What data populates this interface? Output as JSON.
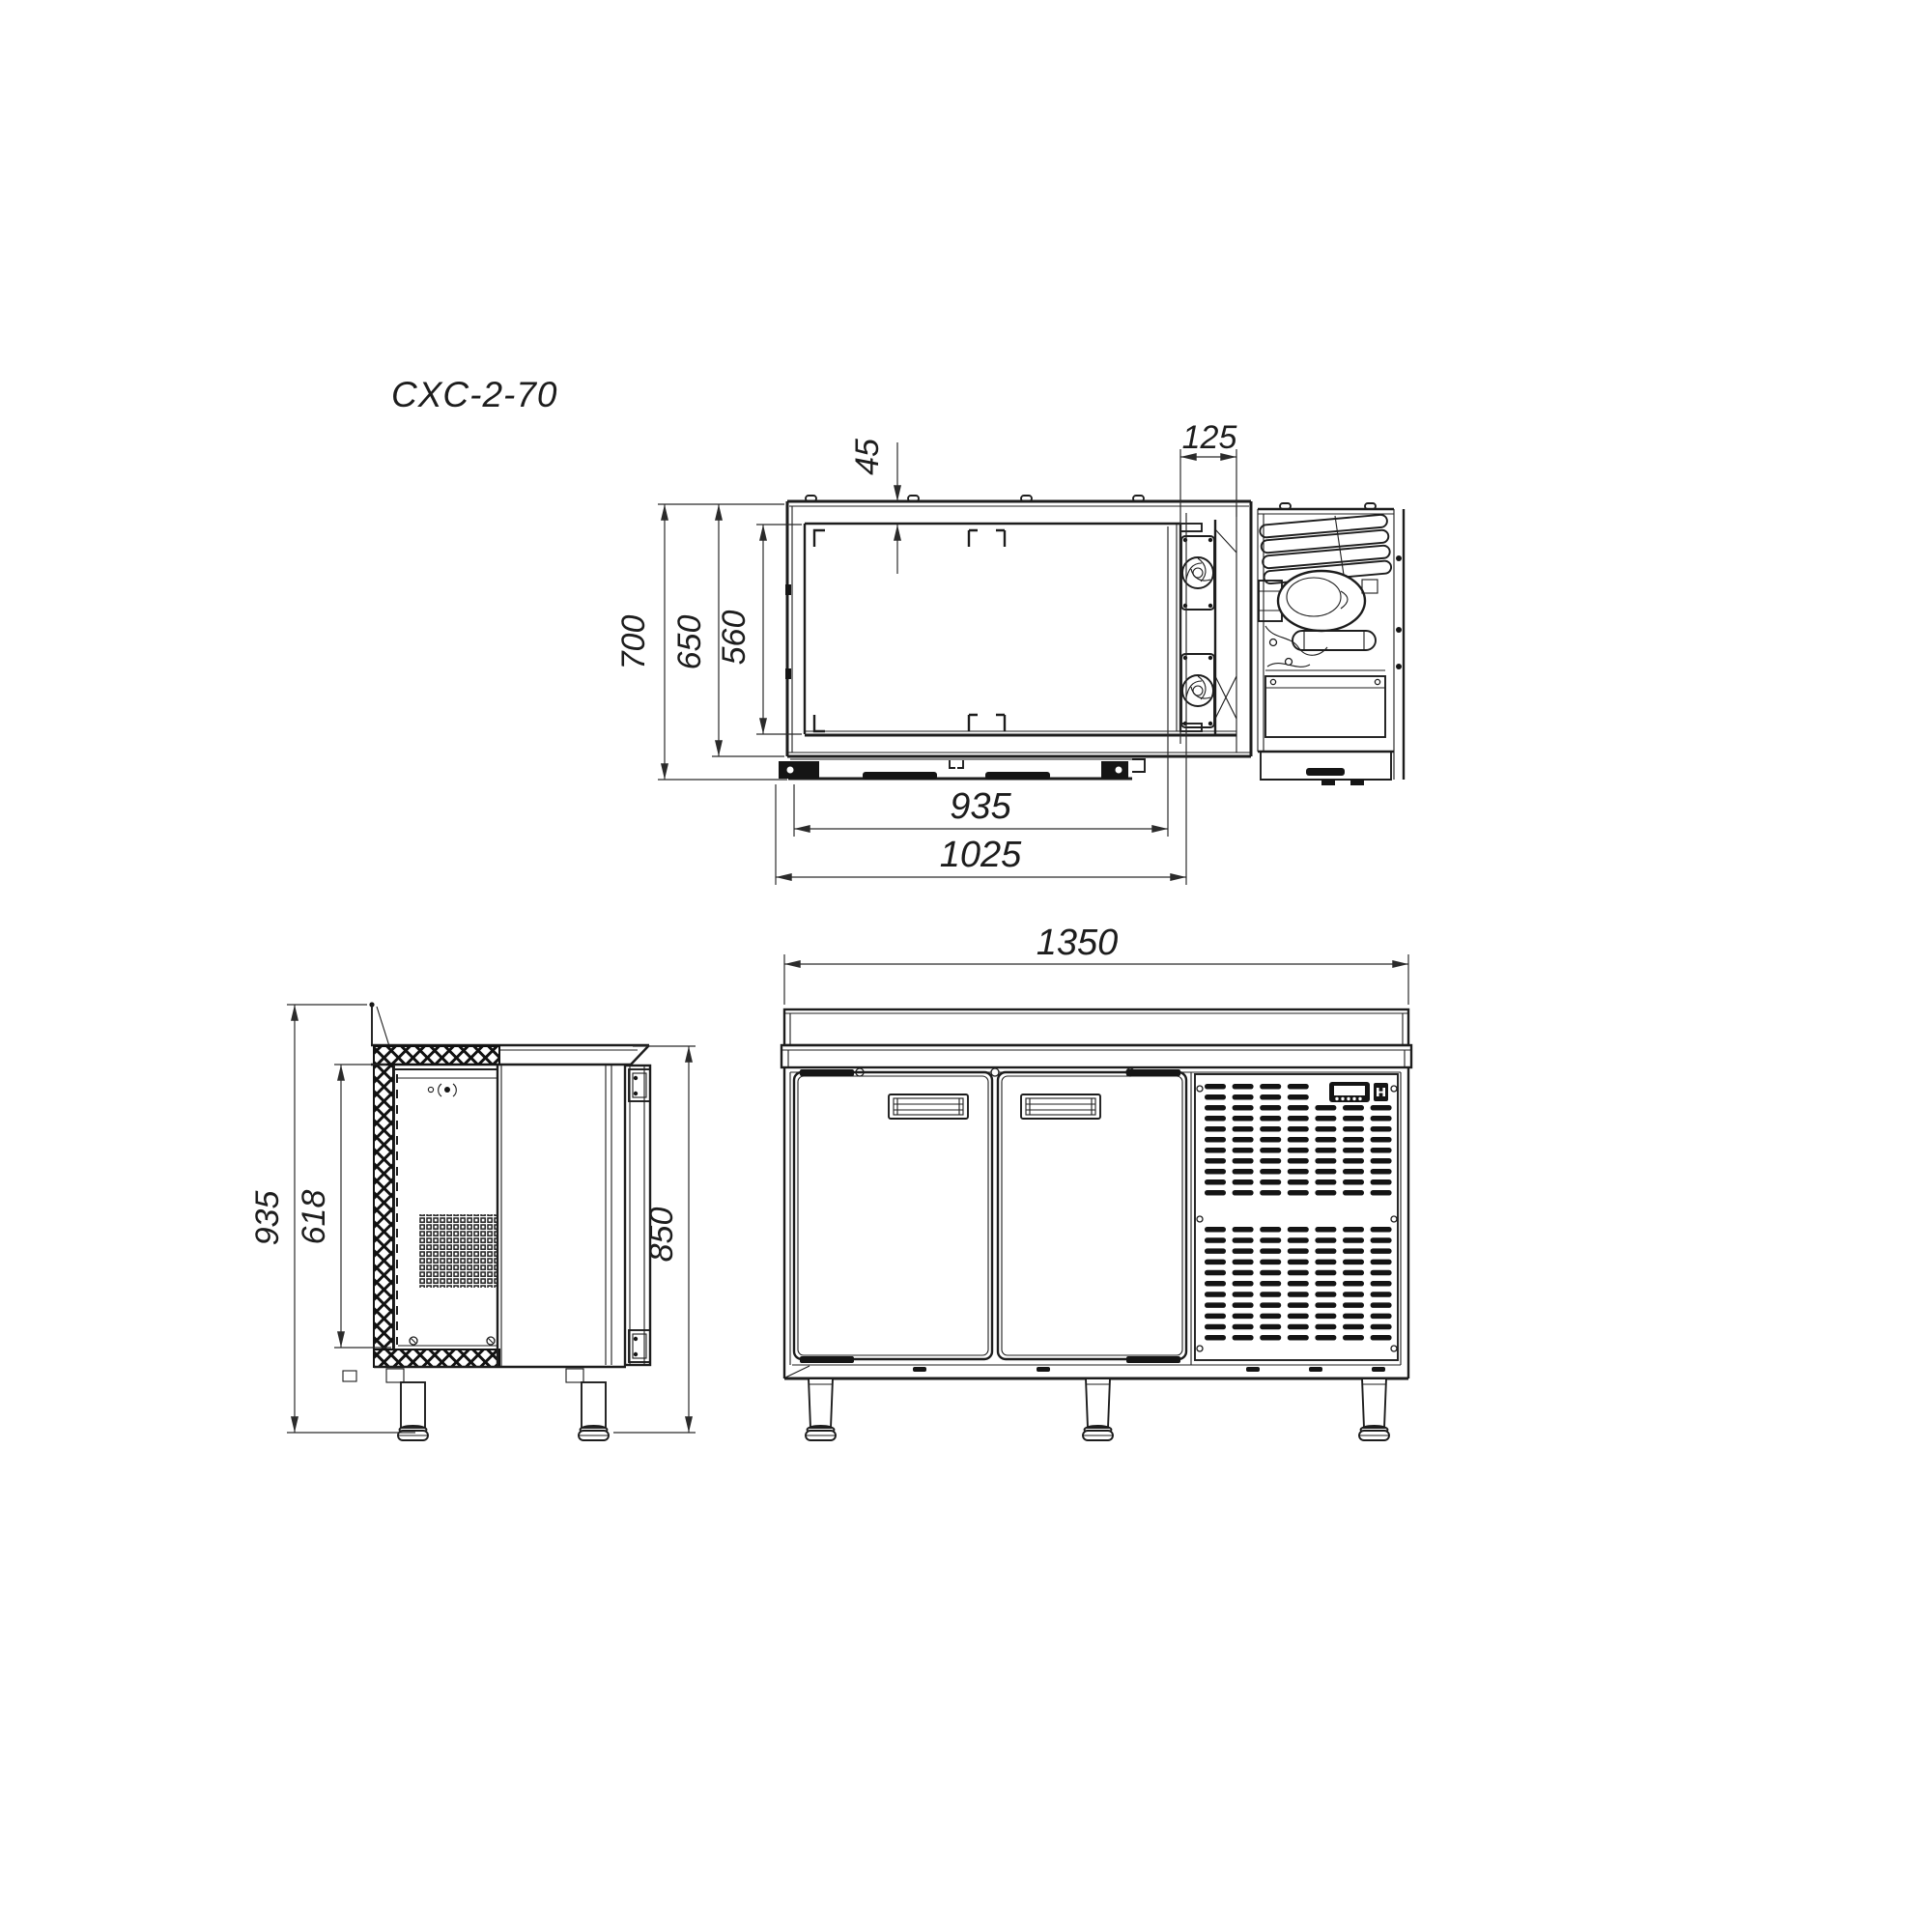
{
  "title": "CXC-2-70",
  "colors": {
    "line": "#1d1d1d",
    "dim_text": "#1d1d1d",
    "background": "#ffffff"
  },
  "drawing": {
    "top_view": {
      "dim_top_offset": "45",
      "dim_fan_bay_width": "125",
      "dim_depth_total": "700",
      "dim_depth_body": "650",
      "dim_depth_interior": "560",
      "dim_width_interior": "935",
      "dim_width_body": "1025"
    },
    "front_view": {
      "dim_width_total": "1350"
    },
    "side_view": {
      "dim_height_total": "935",
      "dim_door_height": "618",
      "dim_worktop_height": "850"
    }
  }
}
